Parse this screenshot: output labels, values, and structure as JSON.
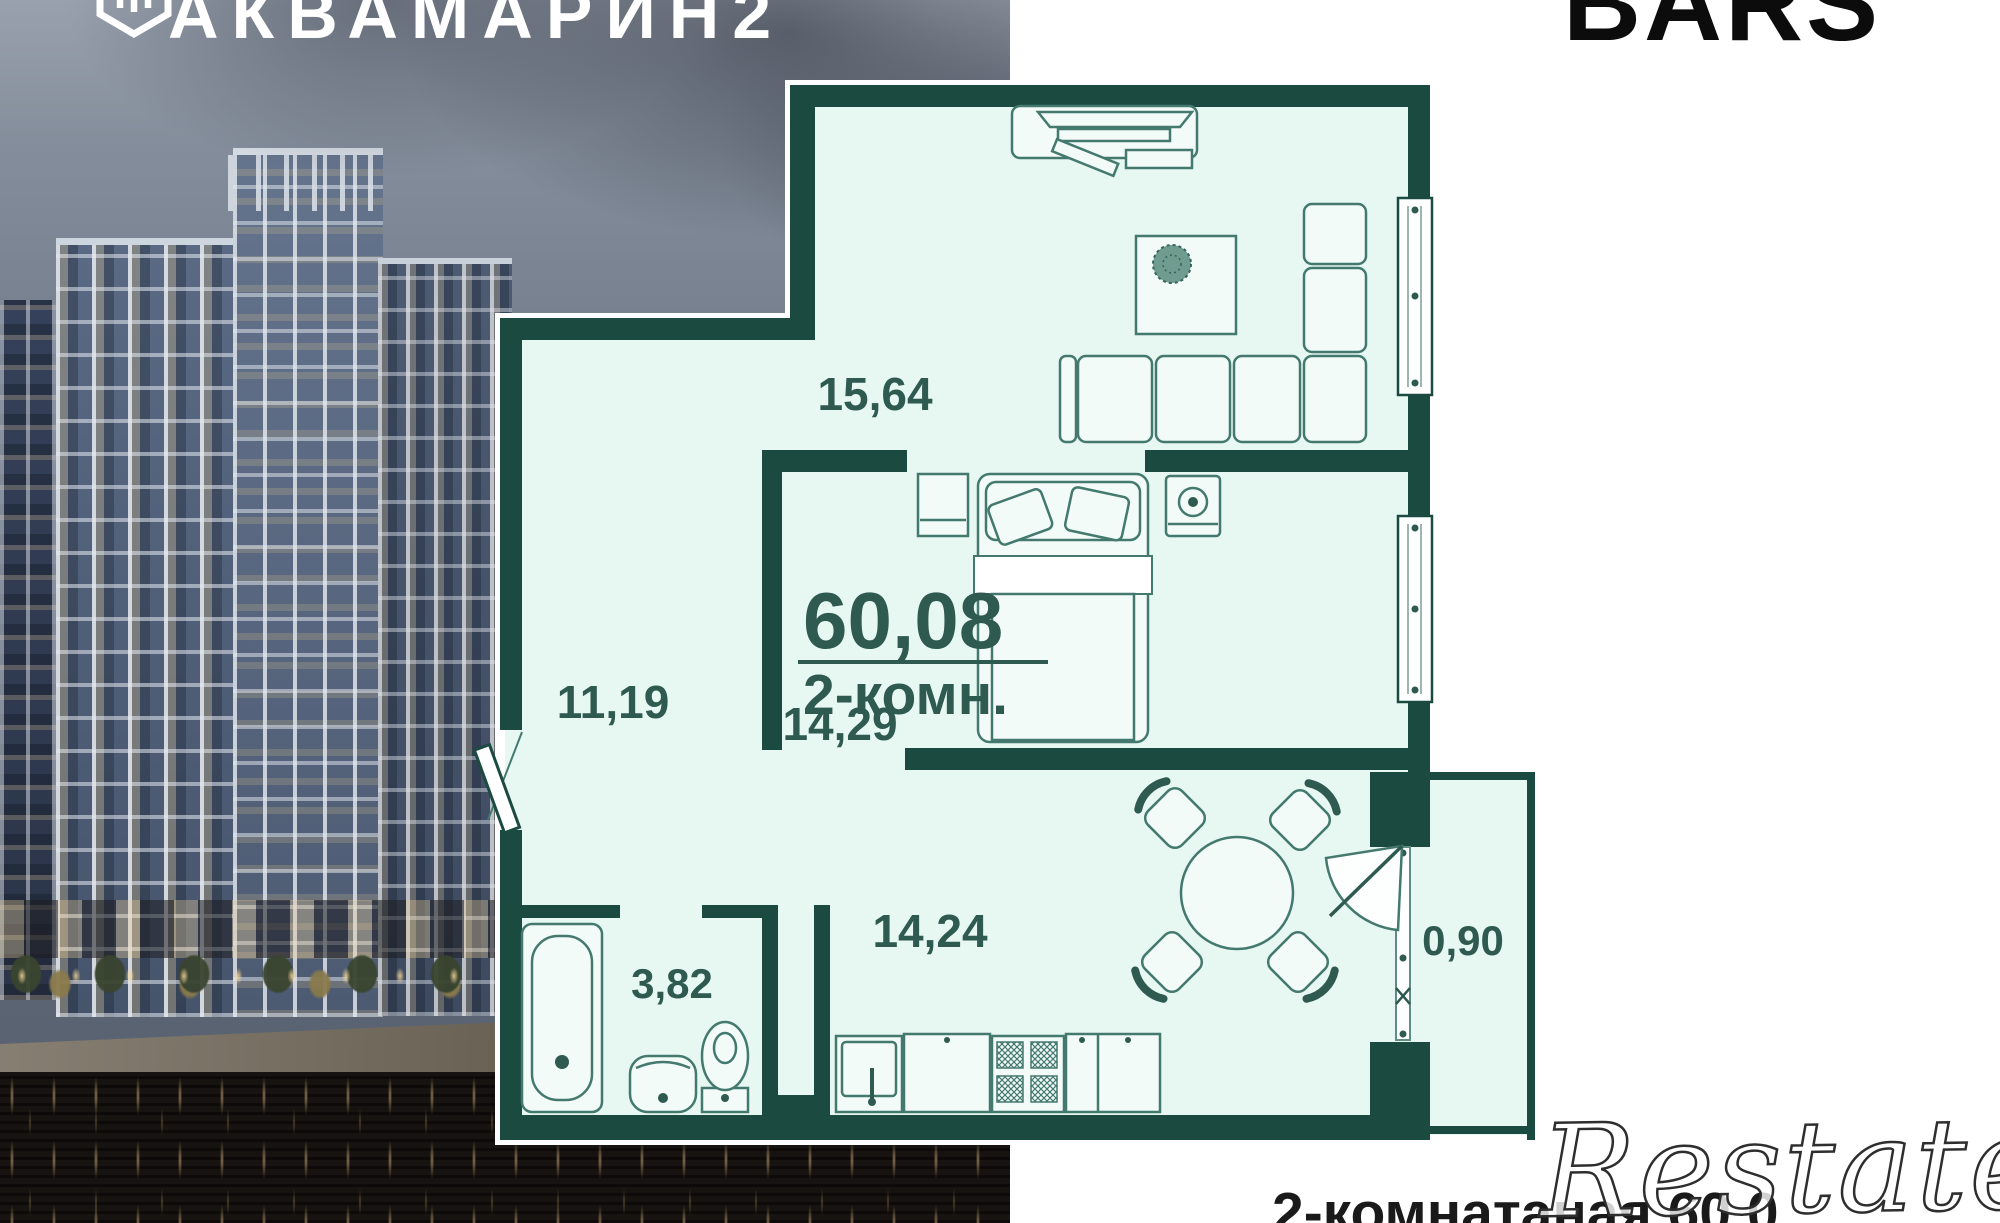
{
  "branding": {
    "developer_logo": "АКВАМАРИН2",
    "developer_logo_icon": "hexagon-emblem-icon",
    "partner_logo": "BARS"
  },
  "floor_plan": {
    "total_area": "60,08",
    "apartment_type": "2-комн.",
    "rooms": [
      {
        "name": "living-room",
        "area": "15,64"
      },
      {
        "name": "bedroom",
        "area": "14,29"
      },
      {
        "name": "hallway",
        "area": "11,19"
      },
      {
        "name": "kitchen-dining",
        "area": "14,24"
      },
      {
        "name": "bathroom",
        "area": "3,82"
      },
      {
        "name": "balcony",
        "area": "0,90"
      }
    ],
    "colors": {
      "wall": "#1b4a40",
      "floor": "#e7f7f2",
      "label": "#2e5a50"
    }
  },
  "footer": {
    "caption": "2-комнатаная 60.0",
    "watermark": "Restate"
  }
}
